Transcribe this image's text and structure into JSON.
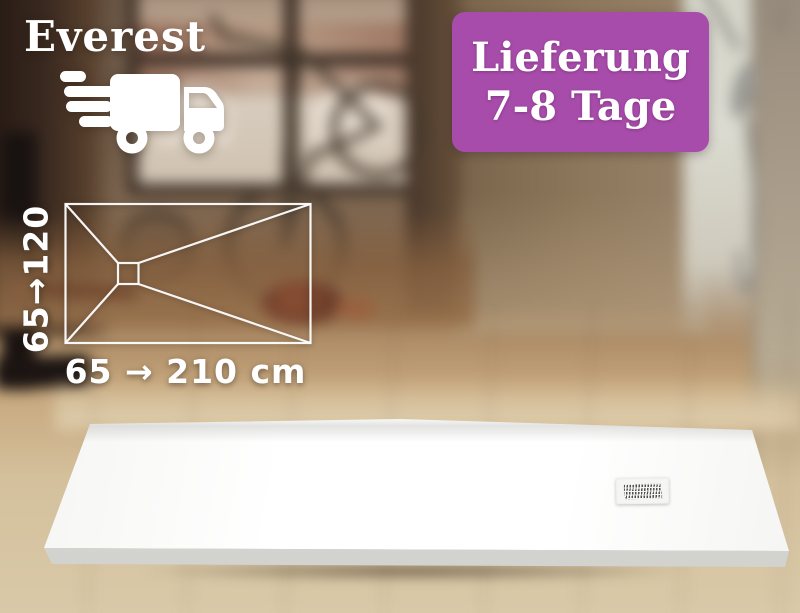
{
  "brand": {
    "name": "Everest",
    "text_color": "#ffffff",
    "icon": "delivery-truck-icon"
  },
  "delivery_badge": {
    "title": "Lieferung",
    "duration": "7-8 Tage",
    "background_color": "#a84cab",
    "text_color": "#ffffff"
  },
  "size_diagram": {
    "depth_label": "65→120",
    "width_label": "65 → 210 cm",
    "line_color": "#ffffff",
    "drain_position": "offset-left-of-center"
  },
  "scene": {
    "subject": "white-shower-tray",
    "setting": "wood-floor-bathroom"
  }
}
